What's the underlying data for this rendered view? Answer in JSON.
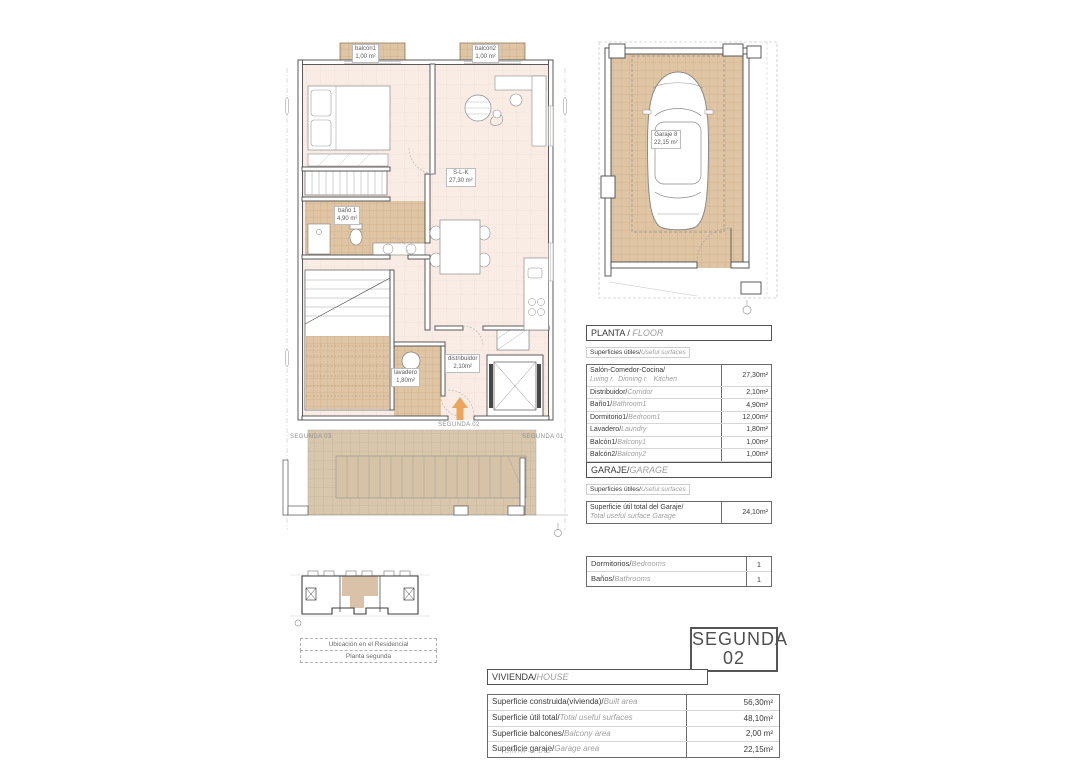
{
  "colors": {
    "accent_orange": "#eba55d",
    "room_fill": "#f9ece5",
    "tile_tan": "#dfc5a4",
    "terrace_tan": "#d8c6ad",
    "wall": "#4a4a4a"
  },
  "floor_plan": {
    "labels": {
      "balcony1": {
        "name": "balcón1",
        "area": "1,00 m²"
      },
      "balcony2": {
        "name": "balcón2",
        "area": "1,00 m²"
      },
      "living": {
        "name": "S-L-K",
        "area": "27,30 m²"
      },
      "bathroom": {
        "name": "baño 1",
        "area": "4,90 m²"
      },
      "laundry": {
        "name": "lavadero",
        "area": "1,80m²"
      },
      "hall": {
        "name": "distribuidor",
        "area": "2,10m²"
      },
      "unit_here": "SEGUNDA 02",
      "unit_left": "SEGUNDA 03",
      "unit_right": "SEGUNDA 01"
    }
  },
  "garage_plan": {
    "label": {
      "name": "Garaje 8",
      "area": "22,15 m²"
    }
  },
  "planta_table": {
    "title": {
      "es": "PLANTA /",
      "en": "FLOOR"
    },
    "subtitle": {
      "es": "Superficies útiles/",
      "en": "Useful surfaces"
    },
    "rows": [
      {
        "es": "Salón-Comedor-Cocina/",
        "en": "Living r.  Dinning r.   Kitchen",
        "value": "27,30m²"
      },
      {
        "es": "Distribuidor/",
        "en": "Corridor",
        "value": "2,10m²"
      },
      {
        "es": "Baño1/",
        "en": "Bathroom1",
        "value": "4,90m²"
      },
      {
        "es": "Dormitorio1/",
        "en": "Bedroom1",
        "value": "12,00m²"
      },
      {
        "es": "Lavadero/",
        "en": "Laundry",
        "value": "1,80m²"
      },
      {
        "es": "Balcón1/",
        "en": "Balcony1",
        "value": "1,00m²"
      },
      {
        "es": "Balcón2/",
        "en": "Balcony2",
        "value": "1,00m²"
      },
      {
        "es": "Superficie útil total / ",
        "en": "Total useful surface",
        "value": "50,10m²"
      }
    ]
  },
  "garaje_table": {
    "title": {
      "es": "GARAJE/",
      "en": "GARAGE"
    },
    "subtitle": {
      "es": "Superficies útiles/",
      "en": "Useful surfaces"
    },
    "rows": [
      {
        "es": "Superficie útil total del Garaje/",
        "en": "Total useful surface Garage",
        "value": "24,10m²"
      }
    ]
  },
  "rooms_table": {
    "rows": [
      {
        "es": "Dormitorios/",
        "en": "Bedrooms",
        "value": "1"
      },
      {
        "es": "Baños/",
        "en": "Bathrooms",
        "value": "1"
      }
    ]
  },
  "unit_box": {
    "line1": "SEGUNDA",
    "line2": "02"
  },
  "vivienda_table": {
    "title": {
      "es": "VIVIENDA/",
      "en": "HOUSE"
    },
    "rows": [
      {
        "es": "Superficie construida(vivienda)/",
        "en": "Built area",
        "value": "56,30m²"
      },
      {
        "es": "Superficie útil total/",
        "en": "Total useful surfaces",
        "value": "48,10m²"
      },
      {
        "es": "Superficie balcones/",
        "en": "Balcony area",
        "value": "2,00 m²"
      },
      {
        "es": "Superficie garaje/",
        "en": "Garage area",
        "value": "22,15m²"
      }
    ]
  },
  "key_plan": {
    "caption_line1": "Ubicación en el Residencial",
    "caption_line2": "Planta segunda"
  },
  "sheet_note": "DIN A4 - e 1/75"
}
